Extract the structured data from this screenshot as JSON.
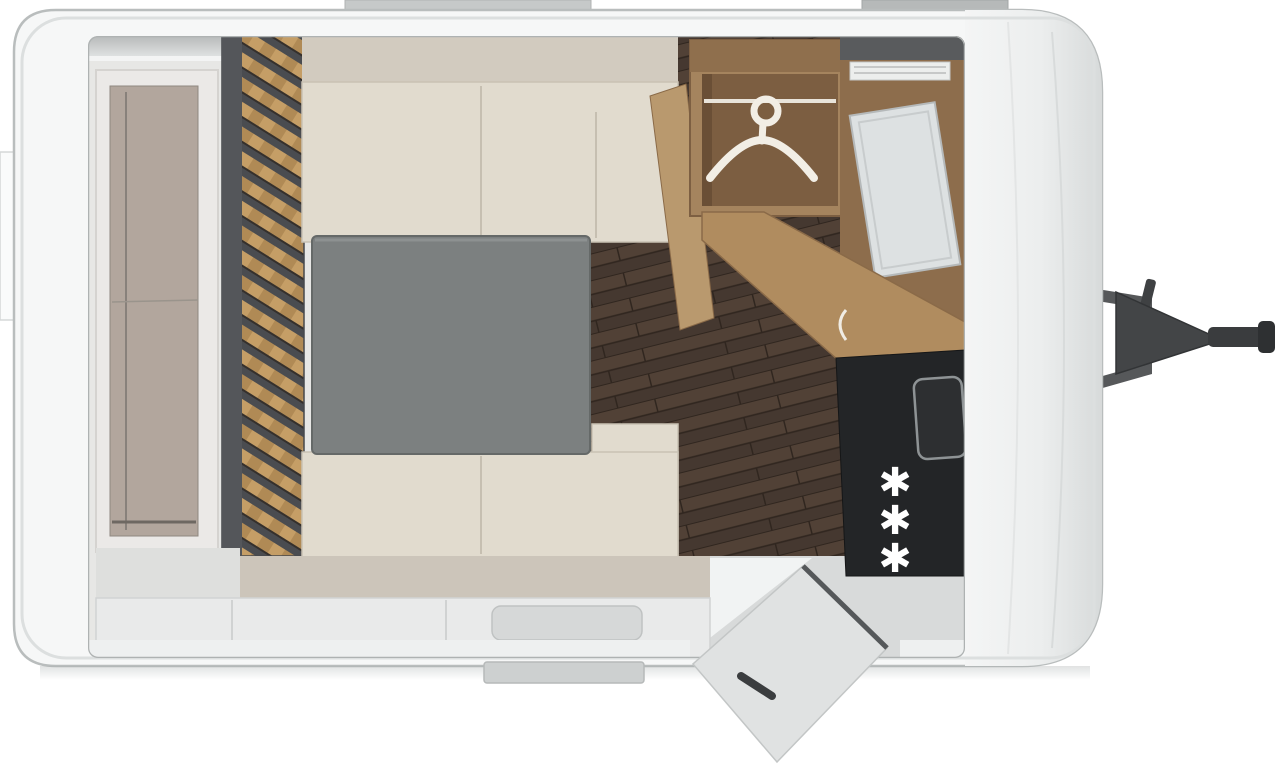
{
  "page": {
    "title": "Caravan floor plan - top view"
  },
  "floorplan": {
    "view": "top-down",
    "regions": [
      "front-storage-shelf",
      "slatted-headboard-wall",
      "dinette-seating",
      "dinette-table",
      "wood-floor",
      "wardrobe",
      "washroom",
      "kitchen",
      "entrance"
    ],
    "wardrobe": {
      "icon": "hanger-icon",
      "fixtures": [
        "clothes-rail"
      ]
    },
    "kitchen": {
      "burner_glyph": "✱",
      "burner_count": 3,
      "fixtures": [
        "sink",
        "cooktop",
        "counter"
      ]
    },
    "entrance": {
      "door_state": "open",
      "fixtures": [
        "entry-step"
      ]
    },
    "exterior": {
      "fixtures": [
        "tow-hitch",
        "roof-vent-rear",
        "roof-vent-front",
        "side-marker"
      ]
    },
    "colors": {
      "body": "#f5f6f6",
      "wall_outline": "#b3b7b7",
      "slat_wood": "#c59e66",
      "slat_base": "#54565a",
      "floor_dark": "#4b3c32",
      "cushion": "#e1dbce",
      "table": "#7c8080",
      "wardrobe_wood": "#a5845e",
      "counter_wood": "#b08c5f",
      "cooktop": "#232527",
      "burner": "#ffffff",
      "door": "#e0e2e2",
      "hitch": "#47494b"
    }
  }
}
